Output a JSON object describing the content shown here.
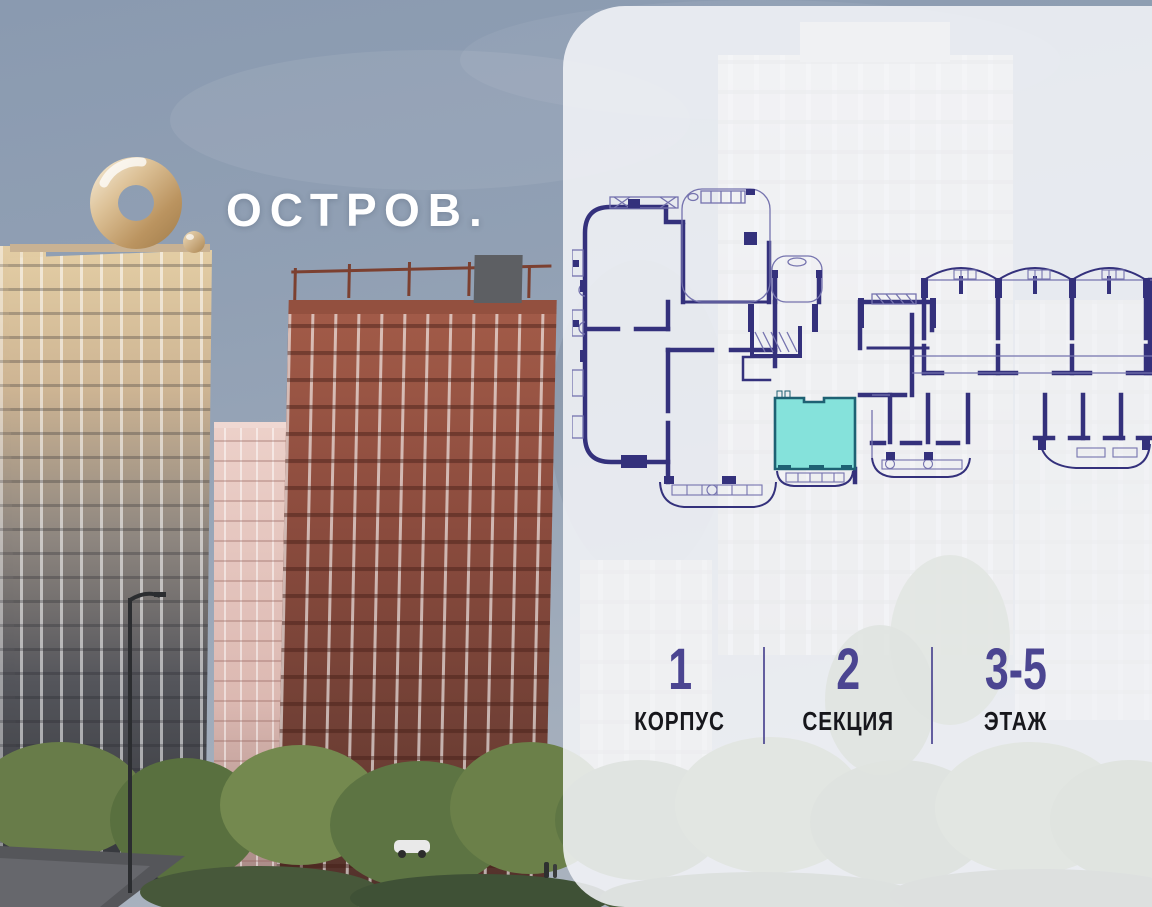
{
  "brand": {
    "name": "ОСТРОВ.",
    "logo_icon": "ostrov-ring-logo"
  },
  "unit_info": {
    "items": [
      {
        "value": "1",
        "label": "КОРПУС"
      },
      {
        "value": "2",
        "label": "СЕКЦИЯ"
      },
      {
        "value": "3-5",
        "label": "ЭТАЖ"
      }
    ]
  },
  "floorplan": {
    "name": "section-floor-plan",
    "highlighted_unit": "selected-apartment",
    "colors": {
      "plan_ink": "#34317C",
      "plan_thin": "#7573AE",
      "unit_fill": "#85E2DB",
      "unit_border": "#1E6173"
    }
  },
  "colors": {
    "accent_purple": "#4B4591",
    "label_dark": "#17171C",
    "logo_gold": "#C9A66F",
    "panel_bg": "rgba(243,245,248,0.87)"
  }
}
